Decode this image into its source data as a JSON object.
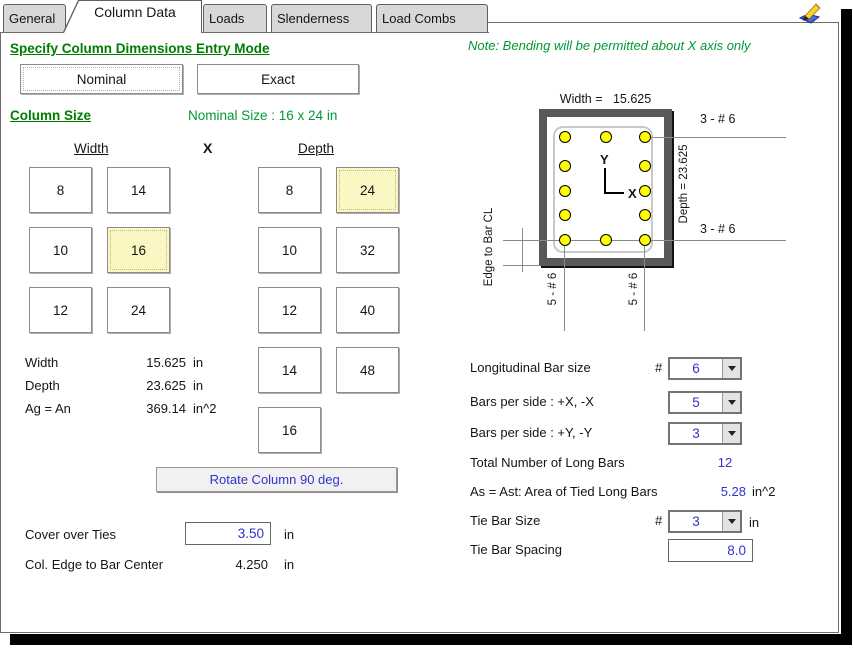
{
  "tabs": {
    "items": [
      {
        "label": "General",
        "active": false
      },
      {
        "label": "Column Data",
        "active": true
      },
      {
        "label": "Loads",
        "active": false
      },
      {
        "label": "Slenderness",
        "active": false
      },
      {
        "label": "Load Combs",
        "active": false
      }
    ]
  },
  "note": "Note: Bending will be permitted about  X axis only",
  "entry_mode": {
    "heading": "Specify Column Dimensions Entry Mode",
    "nominal_label": "Nominal",
    "exact_label": "Exact",
    "selected": "Nominal"
  },
  "column_size": {
    "heading": "Column Size",
    "nominal_size_text": "Nominal Size : 16 x 24 in",
    "width_header": "Width",
    "separator": "X",
    "depth_header": "Depth",
    "width_buttons": [
      "8",
      "14",
      "10",
      "16",
      "12",
      "24"
    ],
    "width_selected": "16",
    "depth_buttons": [
      "8",
      "24",
      "10",
      "32",
      "12",
      "40",
      "14",
      "48",
      "16"
    ],
    "depth_selected": "24",
    "dims": [
      {
        "label": "Width",
        "value": "15.625",
        "unit": "in"
      },
      {
        "label": "Depth",
        "value": "23.625",
        "unit": "in"
      },
      {
        "label": "Ag = An",
        "value": "369.14",
        "unit": "in^2"
      }
    ],
    "rotate_button_label": "Rotate Column 90 deg."
  },
  "cover_over_ties": {
    "label": "Cover over Ties",
    "value": "3.50",
    "unit": "in"
  },
  "edge_to_bar_center": {
    "label": "Col. Edge to Bar Center",
    "value": "4.250",
    "unit": "in"
  },
  "diagram": {
    "width_dim": "Width =   15.625",
    "depth_dim": "Depth =  23.625",
    "top_edge_bars": "3 - # 6",
    "bottom_edge_bars": "3 - # 6",
    "left_side_bars": "5 - # 6",
    "right_side_bars": "5 - # 6",
    "edge_dim_label": "Edge to Bar CL",
    "axis_x_label": "X",
    "axis_y_label": "Y",
    "total_bars_shown": 12,
    "bar_color": "#FFFF00",
    "section_outline_color": "#595959"
  },
  "reinforcement": {
    "long_bar_size": {
      "label": "Longitudinal Bar size",
      "number_prefix": "#",
      "value": "6"
    },
    "bars_per_side_x": {
      "label": "Bars per side : +X, -X",
      "value": "5"
    },
    "bars_per_side_y": {
      "label": "Bars per side : +Y, -Y",
      "value": "3"
    },
    "total_long_bars": {
      "label": "Total Number of Long Bars",
      "value": "12"
    },
    "as_area": {
      "label": "As = Ast: Area of Tied Long Bars",
      "value": "5.28",
      "unit": "in^2"
    },
    "tie_bar_size": {
      "label": "Tie Bar Size",
      "number_prefix": "#",
      "value": "3",
      "unit": "in"
    },
    "tie_bar_spacing": {
      "label": "Tie Bar Spacing",
      "value": "8.0"
    }
  }
}
